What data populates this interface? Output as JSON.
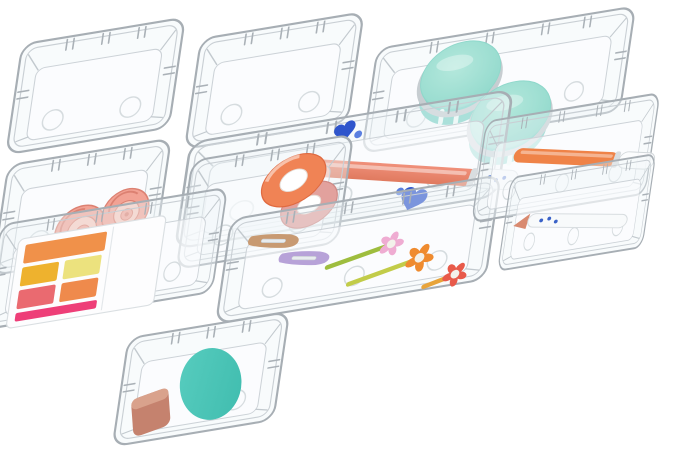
{
  "scene": {
    "type": "product-photograph",
    "background": "#ffffff",
    "subject": "Set of clear plastic drawer organizer bins shown at an angle, filled with cosmetics and stationery"
  },
  "bins": [
    {
      "id": "empty-back-left",
      "size": "small-square",
      "contents": []
    },
    {
      "id": "empty-back-center",
      "size": "small-square",
      "contents": []
    },
    {
      "id": "jars",
      "size": "long",
      "contents": [
        "two mint-lidded cosmetic jars"
      ]
    },
    {
      "id": "roses",
      "size": "small-square",
      "contents": [
        "two salmon rose ornaments"
      ]
    },
    {
      "id": "washi",
      "size": "small-square",
      "contents": [
        "coral washi tape roll",
        "dusty-pink washi tape roll"
      ]
    },
    {
      "id": "pen-center",
      "size": "long",
      "contents": [
        "coral pen with white cap",
        "blue glitter hearts"
      ]
    },
    {
      "id": "palette",
      "size": "medium-rect",
      "contents": [
        "eyeshadow palette with orange, gold, yellow, pink and magenta pans"
      ]
    },
    {
      "id": "clips",
      "size": "long",
      "contents": [
        "tan snap hair clip",
        "lavender snap hair clip",
        "pink, orange and red flower hair clips"
      ]
    },
    {
      "id": "pen-right",
      "size": "long",
      "contents": [
        "orange pen with clear cap"
      ]
    },
    {
      "id": "pen-bottom",
      "size": "long",
      "contents": [
        "white pen with blue dots and coral tip"
      ]
    },
    {
      "id": "sponge",
      "size": "small-square",
      "contents": [
        "teal makeup sponge",
        "mauve wedge sponge"
      ]
    }
  ],
  "colors": {
    "jar_lid": "#b4e8dc",
    "jar_lid_edge": "#8fd8cb",
    "jar_band": "#c7cdd1",
    "jar_body": "#7ed2c7",
    "jar_slit": "#effaf7",
    "rose": "#f2a294",
    "rose_dark": "#dc8172",
    "rose_light": "#f8c9bc",
    "washi_coral": "#f08355",
    "washi_coral_dark": "#e06a40",
    "washi_pink": "#e2a19d",
    "washi_pink_dark": "#cf8a86",
    "washi_hole": "#ffffff",
    "pen_coral": "#f0907a",
    "pen_coral_dark": "#e07a5f",
    "pen_cap_white": "#f7f9fa",
    "pen_orange": "#ef8348",
    "pen_orange_dark": "#e06f32",
    "pen_white": "#f8fafb",
    "pen_tip_coral": "#d98a70",
    "pen_dot_blue": "#3a62c8",
    "heart_blue": "#2f55cc",
    "heart_blue_light": "#5b7fe0",
    "palette_case": "#fdfdfe",
    "palette_orange": "#f0914a",
    "palette_gold": "#eeb22e",
    "palette_yellow": "#ece27e",
    "palette_pink": "#ea6a70",
    "palette_orange2": "#ef8a4c",
    "palette_magenta": "#ee3e78",
    "clip_tan": "#c89a72",
    "clip_lavender": "#b7a2d8",
    "clip_slit": "#e8ecef",
    "stem_green": "#9ebd3e",
    "stem_yellow": "#c2cc49",
    "stem_orange": "#e8a43a",
    "flower_pink": "#efacd2",
    "flower_orange": "#ef8b2f",
    "flower_red": "#e85a4a",
    "flower_center": "#f3f1ea",
    "sponge_teal": "#58cdbf",
    "sponge_teal_dark": "#3fbcae",
    "sponge_mauve": "#c5826e",
    "sponge_mauve_light": "#d9a28c"
  }
}
